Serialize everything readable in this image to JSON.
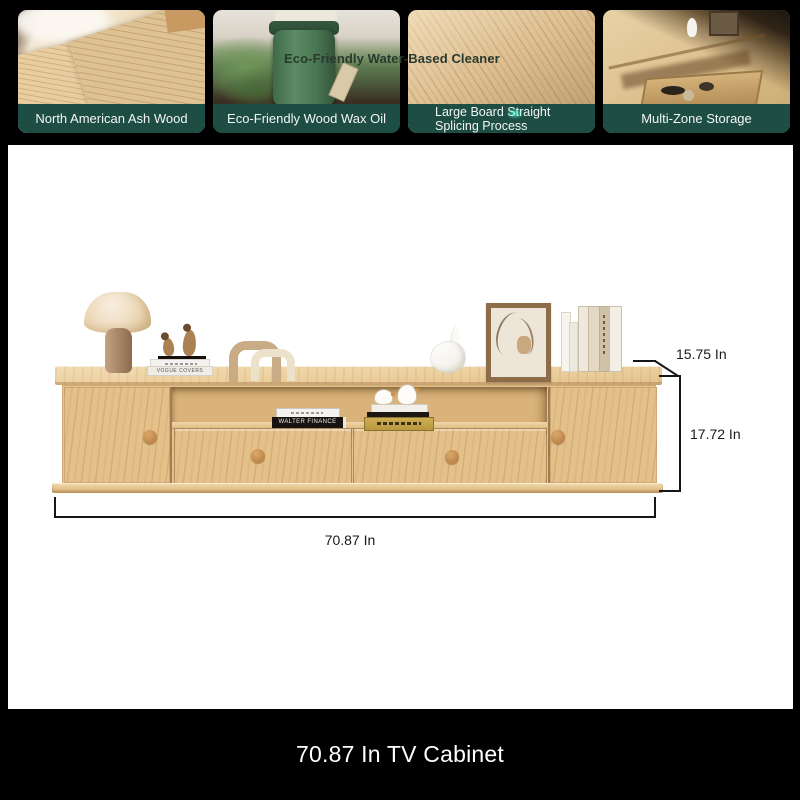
{
  "colors": {
    "accent_green": "#1e4d44",
    "page_black": "#000000",
    "panel_white": "#ffffff",
    "wood_light": "#ecd3a6",
    "wood_mid": "#e3bf88",
    "knob_brown": "#c9934e",
    "dimension_line": "#161616"
  },
  "gallery": {
    "overlay_caption": "Eco-Friendly Water-Based Cleaner",
    "items": [
      {
        "label": "North American Ash Wood",
        "image": "ash-wood-veneer-photo"
      },
      {
        "label": "Eco-Friendly Wood Wax Oil",
        "image": "wood-wax-oil-bucket-photo"
      },
      {
        "label": "Large Board Straight Splicing Process",
        "label_line1": "Large Board Straight",
        "label_line2": "Splicing Process",
        "image": "board-splicing-photo"
      },
      {
        "label": "Multi-Zone Storage",
        "image": "multi-zone-storage-photo"
      }
    ]
  },
  "product": {
    "dimensions": {
      "depth_label": "15.75 In",
      "height_label": "17.72 In",
      "width_label": "70.87 In"
    },
    "decor_text": {
      "book_stack_spine": "VOGUE COVERS",
      "shelf_book_spine": "WALTER FINANCE"
    }
  },
  "footer": {
    "title": "70.87 In TV Cabinet"
  }
}
